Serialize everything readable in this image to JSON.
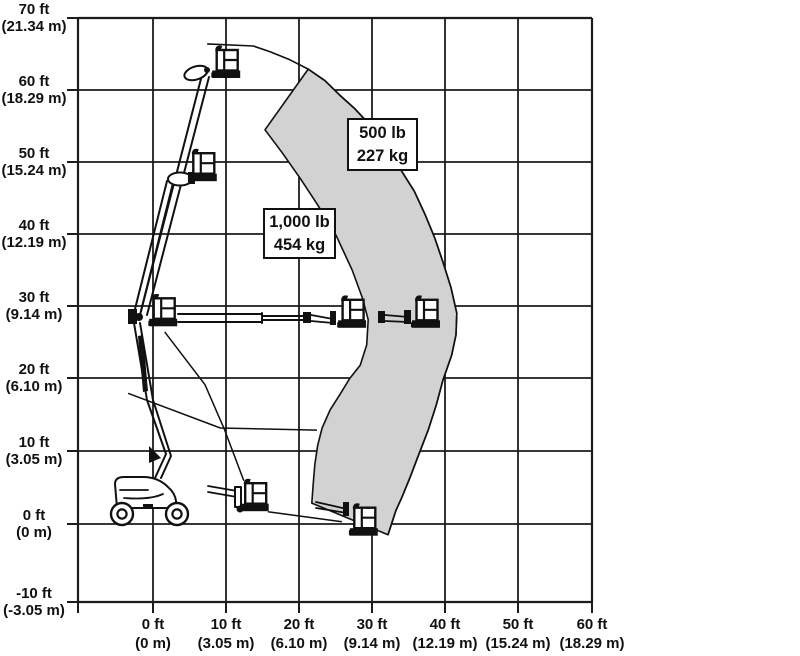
{
  "chart_data": {
    "type": "area",
    "title": "",
    "subtitle": "",
    "description": "Articulated boom lift range-of-motion envelope with two load-capacity zones; multiple platform positions of the machine are illustrated on a ft/m grid.",
    "grid": true,
    "x_axis": {
      "label": "",
      "range_ft": [
        -10,
        60
      ],
      "ticks": [
        {
          "ft": 0,
          "line1": "0 ft",
          "line2": "(0 m)"
        },
        {
          "ft": 10,
          "line1": "10 ft",
          "line2": "(3.05 m)"
        },
        {
          "ft": 20,
          "line1": "20 ft",
          "line2": "(6.10 m)"
        },
        {
          "ft": 30,
          "line1": "30 ft",
          "line2": "(9.14 m)"
        },
        {
          "ft": 40,
          "line1": "40 ft",
          "line2": "(12.19 m)"
        },
        {
          "ft": 50,
          "line1": "50 ft",
          "line2": "(15.24 m)"
        },
        {
          "ft": 60,
          "line1": "60 ft",
          "line2": "(18.29 m)"
        }
      ]
    },
    "y_axis": {
      "label": "",
      "range_ft": [
        -10,
        70
      ],
      "ticks": [
        {
          "ft": 70,
          "line1": "70 ft",
          "line2": "(21.34 m)"
        },
        {
          "ft": 60,
          "line1": "60 ft",
          "line2": "(18.29 m)"
        },
        {
          "ft": 50,
          "line1": "50 ft",
          "line2": "(15.24 m)"
        },
        {
          "ft": 40,
          "line1": "40 ft",
          "line2": "(12.19 m)"
        },
        {
          "ft": 30,
          "line1": "30 ft",
          "line2": "(9.14 m)"
        },
        {
          "ft": 20,
          "line1": "20 ft",
          "line2": "(6.10 m)"
        },
        {
          "ft": 10,
          "line1": "10 ft",
          "line2": "(3.05 m)"
        },
        {
          "ft": 0,
          "line1": "0 ft",
          "line2": "(0 m)"
        },
        {
          "ft": -10,
          "line1": "-10 ft",
          "line2": "(-3.05 m)"
        }
      ]
    },
    "colors": {
      "zone_fill": "#d2d2d2",
      "line": "#111111",
      "grid": "#1c1c1c",
      "background": "#ffffff"
    },
    "capacity_zones": [
      {
        "capacity_lb": 500,
        "capacity_kg": 227,
        "label_lines": [
          "500 lb",
          "227 kg"
        ]
      },
      {
        "capacity_lb": 1000,
        "capacity_kg": 454,
        "label_lines": [
          "1,000 lb",
          "454 kg"
        ]
      }
    ],
    "envelope": {
      "outer_boundary_ft": [
        [
          7.4,
          66.5
        ],
        [
          13.7,
          66.2
        ],
        [
          16.0,
          65.4
        ],
        [
          18.7,
          64.3
        ],
        [
          21.2,
          63.0
        ],
        [
          23.5,
          61.4
        ],
        [
          25.5,
          59.4
        ],
        [
          27.6,
          57.5
        ],
        [
          29.6,
          55.3
        ],
        [
          31.8,
          52.5
        ],
        [
          33.7,
          49.3
        ],
        [
          35.7,
          46.1
        ],
        [
          37.2,
          42.8
        ],
        [
          38.5,
          39.6
        ],
        [
          39.6,
          36.3
        ],
        [
          40.7,
          32.8
        ],
        [
          41.5,
          29.2
        ],
        [
          41.4,
          26.2
        ],
        [
          40.8,
          23.4
        ],
        [
          39.6,
          19.9
        ],
        [
          38.7,
          16.5
        ],
        [
          37.6,
          13.0
        ],
        [
          36.3,
          9.6
        ],
        [
          35.1,
          6.4
        ],
        [
          34.0,
          3.7
        ],
        [
          33.2,
          1.9
        ],
        [
          32.1,
          -1.5
        ]
      ],
      "zone_500lb_inner_boundary_ft": [
        [
          21.7,
          2.9
        ],
        [
          21.9,
          5.7
        ],
        [
          22.1,
          8.2
        ],
        [
          22.5,
          10.9
        ],
        [
          23.1,
          13.3
        ],
        [
          24.2,
          15.8
        ],
        [
          25.5,
          17.9
        ],
        [
          26.9,
          20.2
        ],
        [
          28.3,
          22.0
        ],
        [
          29.2,
          24.8
        ],
        [
          29.4,
          28.3
        ],
        [
          28.6,
          31.3
        ],
        [
          27.2,
          35.2
        ],
        [
          25.0,
          40.0
        ],
        [
          22.5,
          44.2
        ],
        [
          20.1,
          47.9
        ],
        [
          17.6,
          51.5
        ],
        [
          15.3,
          54.6
        ]
      ],
      "zone_500lb_joins_outer_at_ft": [
        21.2,
        63.0
      ],
      "aux_lines_ft": [
        [
          [
            1.6,
            26.6
          ],
          [
            7.1,
            19.3
          ],
          [
            9.8,
            13.0
          ],
          [
            12.4,
            6.0
          ]
        ],
        [
          [
            -3.4,
            18.1
          ],
          [
            9.2,
            13.3
          ],
          [
            22.4,
            13.0
          ]
        ],
        [
          [
            15.7,
            1.7
          ],
          [
            25.8,
            0.3
          ]
        ]
      ],
      "max_reach_ft": 41.5,
      "max_platform_height_ft": 66.5
    },
    "platform_positions_ft": [
      {
        "reach": 10.0,
        "floor_height": 61.5
      },
      {
        "reach": 6.8,
        "floor_height": 47.2
      },
      {
        "reach": 1.4,
        "floor_height": 27.1
      },
      {
        "reach": 27.2,
        "floor_height": 26.9
      },
      {
        "reach": 37.3,
        "floor_height": 26.9
      },
      {
        "reach": 13.9,
        "floor_height": 1.5
      },
      {
        "reach": 28.8,
        "floor_height": -1.9
      }
    ]
  }
}
